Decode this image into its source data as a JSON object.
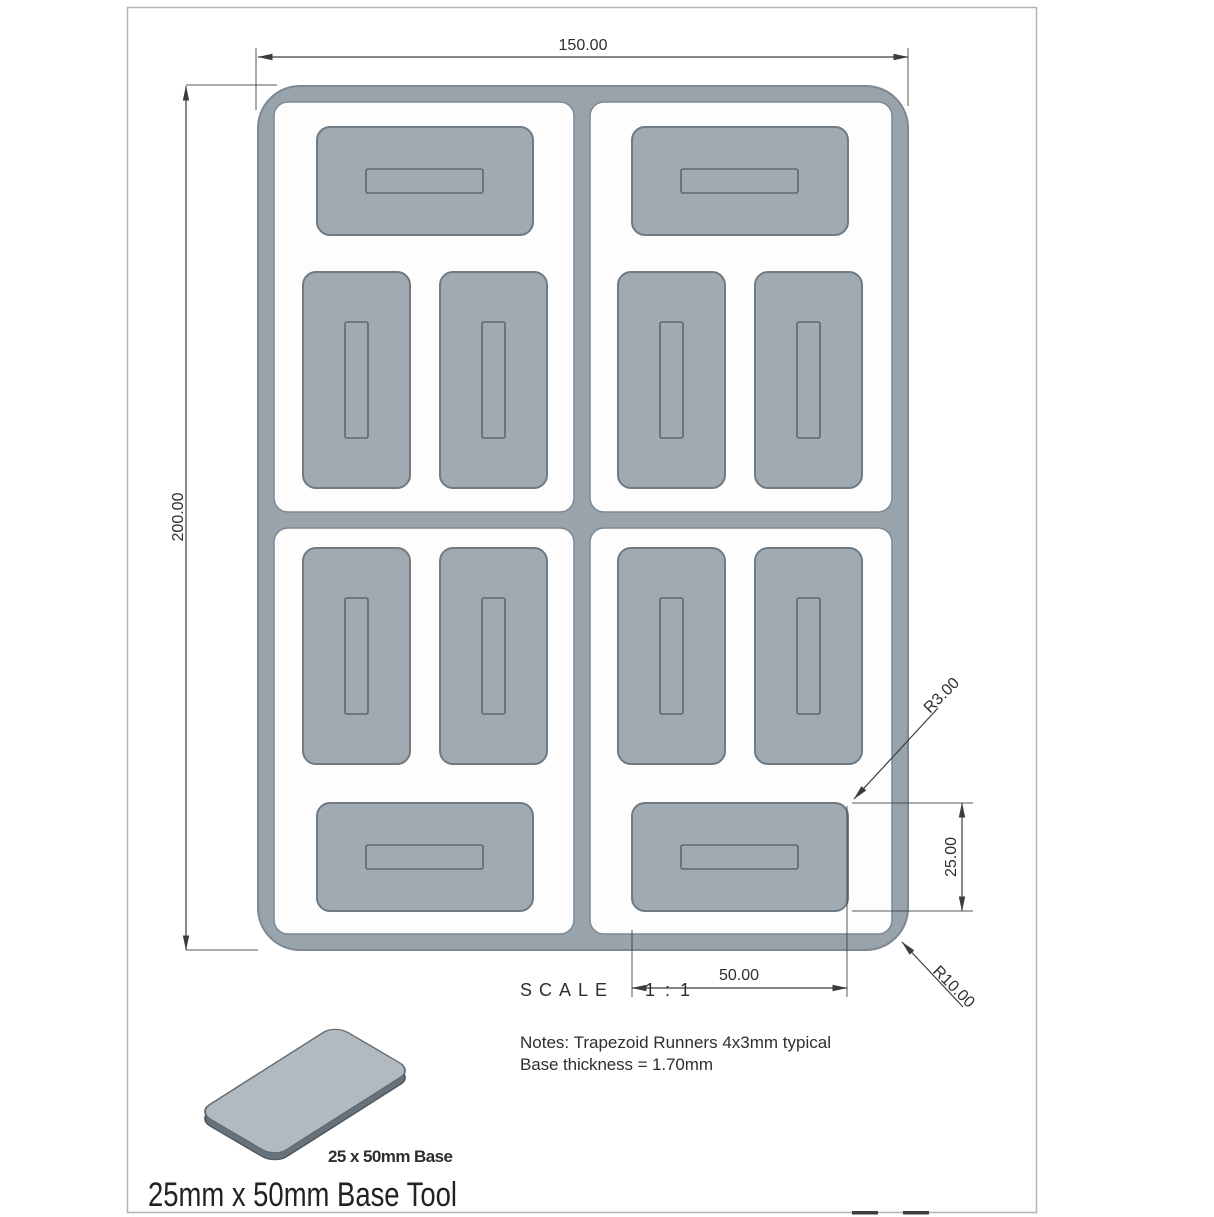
{
  "sheet": {
    "title": "25mm x 50mm Base Tool"
  },
  "front_view": {
    "dimensions": {
      "overall_width": "150.00",
      "overall_height": "200.00",
      "base_width": "50.00",
      "base_height": "25.00",
      "base_corner_radius": "R3.00",
      "tool_corner_radius": "R10.00"
    },
    "scale": {
      "label": "SCALE",
      "value": "1:1"
    }
  },
  "notes": {
    "line1": "Notes: Trapezoid Runners 4x3mm typical",
    "line2": "Base thickness = 1.70mm"
  },
  "iso_view": {
    "caption": "25 x 50mm Base"
  },
  "colors": {
    "tool_frame": "#98a3ab",
    "base_fill": "#a1aab1",
    "cavity_fill": "#fdfdfe",
    "part_outline": "#6f7a84",
    "dimension_lines": "#3c3c3c",
    "iso_top": "#b2bac1",
    "iso_side": "#68727b",
    "page_border": "#b3b3b3"
  }
}
